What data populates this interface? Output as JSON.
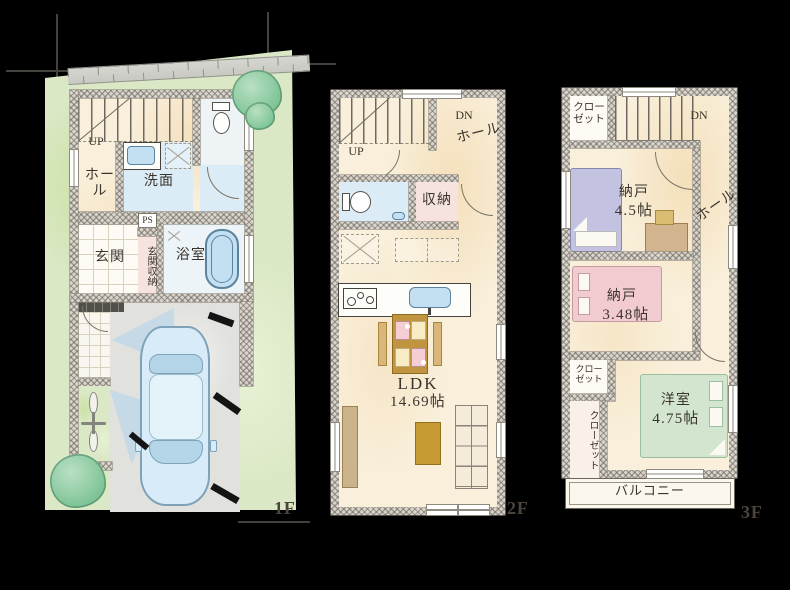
{
  "colors": {
    "background": "#000000",
    "floor_cream": "#f9efda",
    "lawn_green": "#dbe8c5",
    "water_blue": "#dcecf6",
    "storage_pink": "#f7e3de",
    "bed_purple": "#c3c3e1",
    "bed_pink": "#f2cbd0",
    "bed_green": "#d3e5cf",
    "furniture_gold": "#c59a33",
    "label_ink": "#3a342d"
  },
  "f1": {
    "floor_label": "1F",
    "up": "UP",
    "hall": "ホール",
    "washroom": "洗面",
    "ps": "PS",
    "entrance": "玄関",
    "entrance_storage": "玄関収納",
    "bathroom": "浴室"
  },
  "f2": {
    "floor_label": "2F",
    "up": "UP",
    "dn": "DN",
    "hall": "ホール",
    "storage": "収納",
    "ldk": "LDK",
    "ldk_size": "14.69帖"
  },
  "f3": {
    "floor_label": "3F",
    "dn": "DN",
    "closet_top": "クロー\nゼット",
    "hall": "ホール",
    "nando1": "納戸",
    "nando1_size": "4.5帖",
    "nando2": "納戸",
    "nando2_size": "3.48帖",
    "closet_mid": "クロー\nゼット",
    "closet_left": "クローゼット",
    "western": "洋室",
    "western_size": "4.75帖",
    "balcony": "バルコニー"
  }
}
